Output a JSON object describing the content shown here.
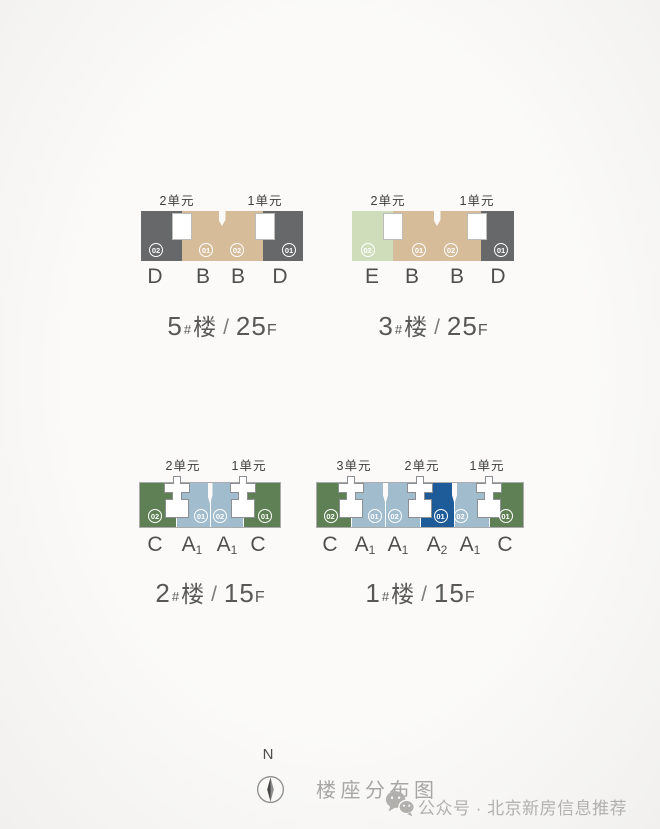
{
  "page": {
    "north": "N",
    "caption": "楼座分布图",
    "watermark": "公众号 · 北京新房信息推荐"
  },
  "colors": {
    "dark_gray": "#66686a",
    "tan": "#d6bc99",
    "light_green": "#cfddba",
    "green": "#5e8054",
    "light_blue": "#a1bccd",
    "dark_blue": "#1e5c99",
    "core_white": "#ffffff",
    "background": "#f9f8f6"
  },
  "buildings": [
    {
      "name": "5",
      "hash": "#",
      "lou": "楼",
      "slash": "/",
      "floors": "25",
      "f": "F",
      "units": [
        {
          "label": "2单元"
        },
        {
          "label": "1单元"
        }
      ],
      "sections": [
        {
          "letter": "D",
          "sub": "",
          "badge": "02"
        },
        {
          "letter": "B",
          "sub": "",
          "badge": "01"
        },
        {
          "letter": "B",
          "sub": "",
          "badge": "02"
        },
        {
          "letter": "D",
          "sub": "",
          "badge": "01"
        }
      ]
    },
    {
      "name": "3",
      "hash": "#",
      "lou": "楼",
      "slash": "/",
      "floors": "25",
      "f": "F",
      "units": [
        {
          "label": "2单元"
        },
        {
          "label": "1单元"
        }
      ],
      "sections": [
        {
          "letter": "E",
          "sub": "",
          "badge": "02"
        },
        {
          "letter": "B",
          "sub": "",
          "badge": "01"
        },
        {
          "letter": "B",
          "sub": "",
          "badge": "02"
        },
        {
          "letter": "D",
          "sub": "",
          "badge": "01"
        }
      ]
    },
    {
      "name": "2",
      "hash": "#",
      "lou": "楼",
      "slash": "/",
      "floors": "15",
      "f": "F",
      "units": [
        {
          "label": "2单元"
        },
        {
          "label": "1单元"
        }
      ],
      "sections": [
        {
          "letter": "C",
          "sub": "",
          "badge": "02"
        },
        {
          "letter": "A",
          "sub": "1",
          "badge": "01"
        },
        {
          "letter": "A",
          "sub": "1",
          "badge": "02"
        },
        {
          "letter": "C",
          "sub": "",
          "badge": "01"
        }
      ]
    },
    {
      "name": "1",
      "hash": "#",
      "lou": "楼",
      "slash": "/",
      "floors": "15",
      "f": "F",
      "units": [
        {
          "label": "3单元"
        },
        {
          "label": "2单元"
        },
        {
          "label": "1单元"
        }
      ],
      "sections": [
        {
          "letter": "C",
          "sub": "",
          "badge": "02"
        },
        {
          "letter": "A",
          "sub": "1",
          "badge": "01"
        },
        {
          "letter": "A",
          "sub": "1",
          "badge": "02"
        },
        {
          "letter": "A",
          "sub": "2",
          "badge": "01"
        },
        {
          "letter": "A",
          "sub": "1",
          "badge": "02"
        },
        {
          "letter": "C",
          "sub": "",
          "badge": "01"
        }
      ]
    }
  ]
}
